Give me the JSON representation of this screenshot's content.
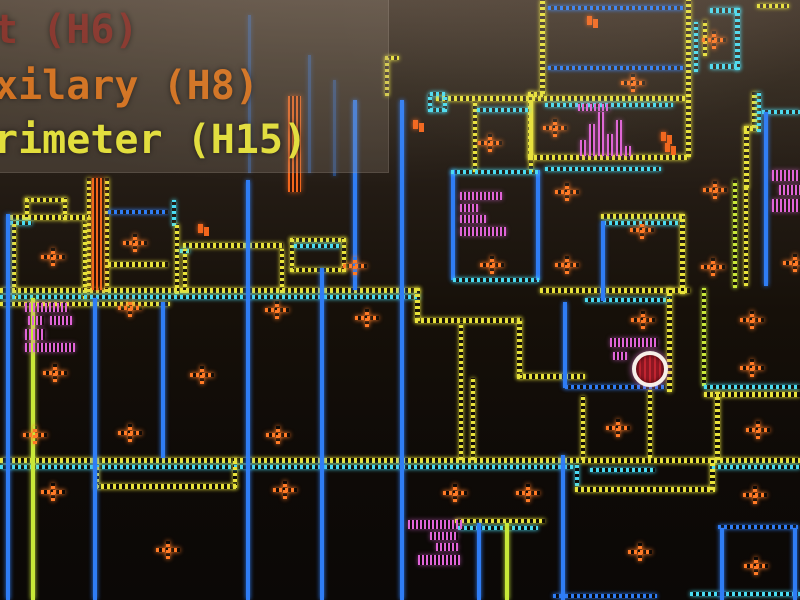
{
  "legend": {
    "items": [
      {
        "label": "t (H6)",
        "color": "#8a2e26"
      },
      {
        "label": "xilary (H8)",
        "color": "#d2711f"
      },
      {
        "label": "rimeter (H15)",
        "color": "#e2de3c"
      }
    ]
  },
  "palette": {
    "Y": "#e8e23a",
    "C": "#4adcf2",
    "B": "#2f7df5",
    "G": "#c8e838",
    "O": "#ff7a26",
    "M": "#e064d8",
    "O2": "#f2661c",
    "player_fill": "#a01828",
    "player_ring": "#f6eee8"
  },
  "map": {
    "walls": [
      [
        25,
        198,
        42,
        4,
        "Y",
        0
      ],
      [
        25,
        198,
        4,
        22,
        "Y",
        0
      ],
      [
        63,
        198,
        4,
        22,
        "Y",
        0
      ],
      [
        10,
        215,
        80,
        5,
        "Y",
        0
      ],
      [
        10,
        221,
        22,
        4,
        "C",
        0
      ],
      [
        12,
        221,
        4,
        78,
        "Y",
        0
      ],
      [
        83,
        221,
        4,
        78,
        "Y",
        0
      ],
      [
        87,
        178,
        4,
        114,
        "Y",
        0
      ],
      [
        105,
        178,
        4,
        114,
        "Y",
        0
      ],
      [
        108,
        210,
        60,
        4,
        "B",
        0
      ],
      [
        172,
        200,
        4,
        26,
        "C",
        0
      ],
      [
        175,
        224,
        4,
        70,
        "Y",
        0
      ],
      [
        108,
        262,
        60,
        5,
        "Y",
        0
      ],
      [
        183,
        243,
        100,
        5,
        "Y",
        0
      ],
      [
        180,
        249,
        10,
        4,
        "C",
        0
      ],
      [
        183,
        249,
        4,
        44,
        "Y",
        0
      ],
      [
        280,
        249,
        4,
        44,
        "Y",
        0
      ],
      [
        290,
        238,
        56,
        4,
        "Y",
        0
      ],
      [
        290,
        238,
        4,
        34,
        "Y",
        0
      ],
      [
        342,
        238,
        4,
        34,
        "Y",
        0
      ],
      [
        290,
        268,
        56,
        4,
        "Y",
        0
      ],
      [
        294,
        244,
        46,
        4,
        "C",
        0
      ],
      [
        0,
        288,
        420,
        5,
        "Y",
        0
      ],
      [
        0,
        295,
        420,
        4,
        "C",
        0
      ],
      [
        0,
        302,
        170,
        4,
        "Y",
        0
      ],
      [
        540,
        288,
        150,
        5,
        "Y",
        0
      ],
      [
        585,
        298,
        85,
        4,
        "C",
        0
      ],
      [
        415,
        288,
        5,
        33,
        "Y",
        0
      ],
      [
        415,
        318,
        106,
        5,
        "Y",
        0
      ],
      [
        517,
        318,
        5,
        60,
        "Y",
        0
      ],
      [
        517,
        374,
        68,
        5,
        "Y",
        0
      ],
      [
        459,
        322,
        4,
        138,
        "Y",
        0
      ],
      [
        471,
        378,
        4,
        82,
        "Y",
        0
      ],
      [
        563,
        302,
        4,
        86,
        "B",
        1
      ],
      [
        565,
        385,
        100,
        4,
        "B",
        0
      ],
      [
        667,
        288,
        5,
        104,
        "Y",
        0
      ],
      [
        581,
        396,
        4,
        64,
        "Y",
        0
      ],
      [
        648,
        390,
        4,
        68,
        "Y",
        0
      ],
      [
        702,
        288,
        4,
        98,
        "G",
        0
      ],
      [
        704,
        385,
        96,
        4,
        "C",
        0
      ],
      [
        704,
        392,
        96,
        5,
        "Y",
        0
      ],
      [
        715,
        392,
        5,
        68,
        "Y",
        0
      ],
      [
        601,
        214,
        82,
        5,
        "Y",
        0
      ],
      [
        603,
        221,
        78,
        4,
        "C",
        0
      ],
      [
        601,
        221,
        4,
        80,
        "B",
        1
      ],
      [
        680,
        214,
        5,
        80,
        "Y",
        0
      ],
      [
        733,
        180,
        4,
        108,
        "G",
        0
      ],
      [
        744,
        186,
        4,
        100,
        "Y",
        0
      ],
      [
        744,
        126,
        5,
        62,
        "Y",
        0
      ],
      [
        744,
        126,
        14,
        5,
        "Y",
        0
      ],
      [
        752,
        92,
        5,
        36,
        "Y",
        0
      ],
      [
        757,
        92,
        4,
        40,
        "C",
        0
      ],
      [
        762,
        110,
        38,
        4,
        "C",
        0
      ],
      [
        764,
        112,
        4,
        174,
        "B",
        1
      ],
      [
        540,
        0,
        5,
        94,
        "Y",
        0
      ],
      [
        528,
        92,
        5,
        65,
        "Y",
        0
      ],
      [
        528,
        92,
        18,
        5,
        "Y",
        0
      ],
      [
        686,
        0,
        5,
        157,
        "Y",
        0
      ],
      [
        694,
        22,
        4,
        50,
        "C",
        0
      ],
      [
        548,
        6,
        136,
        4,
        "B",
        0
      ],
      [
        548,
        66,
        136,
        4,
        "B",
        0
      ],
      [
        436,
        96,
        250,
        5,
        "Y",
        0
      ],
      [
        545,
        103,
        128,
        4,
        "C",
        0
      ],
      [
        528,
        155,
        160,
        5,
        "Y",
        0
      ],
      [
        545,
        167,
        116,
        4,
        "C",
        0
      ],
      [
        735,
        8,
        5,
        62,
        "C",
        0
      ],
      [
        710,
        8,
        30,
        5,
        "C",
        0
      ],
      [
        710,
        64,
        30,
        5,
        "C",
        0
      ],
      [
        703,
        20,
        4,
        36,
        "Y",
        0
      ],
      [
        757,
        4,
        32,
        4,
        "Y",
        0
      ],
      [
        428,
        94,
        4,
        18,
        "C",
        0
      ],
      [
        443,
        94,
        4,
        18,
        "C",
        0
      ],
      [
        430,
        92,
        15,
        4,
        "C",
        0
      ],
      [
        430,
        108,
        15,
        4,
        "C",
        0
      ],
      [
        473,
        101,
        4,
        71,
        "Y",
        0
      ],
      [
        529,
        101,
        4,
        71,
        "Y",
        0
      ],
      [
        477,
        108,
        52,
        4,
        "C",
        0
      ],
      [
        451,
        170,
        4,
        110,
        "B",
        1
      ],
      [
        536,
        170,
        4,
        110,
        "B",
        1
      ],
      [
        451,
        170,
        88,
        4,
        "C",
        0
      ],
      [
        453,
        278,
        86,
        4,
        "C",
        0
      ],
      [
        0,
        458,
        800,
        5,
        "Y",
        0
      ],
      [
        0,
        465,
        573,
        4,
        "C",
        0
      ],
      [
        712,
        465,
        88,
        4,
        "C",
        0
      ],
      [
        95,
        458,
        4,
        30,
        "Y",
        0
      ],
      [
        95,
        484,
        142,
        5,
        "Y",
        0
      ],
      [
        233,
        458,
        4,
        30,
        "Y",
        0
      ],
      [
        575,
        464,
        4,
        22,
        "C",
        0
      ],
      [
        590,
        468,
        65,
        4,
        "C",
        0
      ],
      [
        575,
        487,
        140,
        5,
        "Y",
        0
      ],
      [
        710,
        458,
        5,
        32,
        "Y",
        0
      ],
      [
        718,
        525,
        80,
        4,
        "B",
        0
      ],
      [
        455,
        519,
        90,
        4,
        "Y",
        0
      ],
      [
        458,
        526,
        80,
        4,
        "C",
        0
      ],
      [
        553,
        594,
        104,
        4,
        "B",
        0
      ],
      [
        690,
        592,
        110,
        4,
        "C",
        0
      ],
      [
        6,
        214,
        4,
        386,
        "B",
        1
      ],
      [
        31,
        298,
        4,
        302,
        "G",
        1
      ],
      [
        93,
        298,
        4,
        302,
        "B",
        1
      ],
      [
        161,
        302,
        4,
        156,
        "B",
        1
      ],
      [
        246,
        180,
        4,
        420,
        "B",
        1
      ],
      [
        320,
        268,
        4,
        332,
        "B",
        1
      ],
      [
        353,
        100,
        4,
        190,
        "B",
        1
      ],
      [
        400,
        100,
        4,
        500,
        "B",
        1
      ],
      [
        477,
        523,
        4,
        77,
        "B",
        1
      ],
      [
        505,
        523,
        4,
        77,
        "G",
        1
      ],
      [
        561,
        455,
        4,
        145,
        "B",
        1
      ],
      [
        720,
        528,
        4,
        72,
        "B",
        1
      ],
      [
        793,
        528,
        4,
        72,
        "B",
        1
      ],
      [
        248,
        15,
        3,
        158,
        "B",
        1,
        0.45
      ],
      [
        308,
        55,
        3,
        118,
        "B",
        1,
        0.45
      ],
      [
        333,
        80,
        3,
        96,
        "B",
        1,
        0.45
      ],
      [
        385,
        56,
        14,
        4,
        "Y",
        0
      ],
      [
        385,
        58,
        4,
        38,
        "Y",
        0
      ]
    ],
    "magenta_blocks": [
      [
        25,
        303,
        44,
        9
      ],
      [
        28,
        316,
        16,
        9
      ],
      [
        50,
        316,
        22,
        9
      ],
      [
        25,
        329,
        20,
        11
      ],
      [
        25,
        343,
        50,
        9
      ],
      [
        578,
        104,
        32,
        7
      ],
      [
        580,
        140,
        6,
        16
      ],
      [
        589,
        124,
        6,
        32
      ],
      [
        598,
        112,
        6,
        44
      ],
      [
        607,
        134,
        6,
        22
      ],
      [
        616,
        120,
        6,
        36
      ],
      [
        625,
        146,
        6,
        10
      ],
      [
        460,
        192,
        42,
        8
      ],
      [
        460,
        204,
        18,
        8
      ],
      [
        460,
        215,
        26,
        8
      ],
      [
        460,
        227,
        46,
        9
      ],
      [
        772,
        170,
        28,
        11
      ],
      [
        779,
        185,
        21,
        10
      ],
      [
        772,
        199,
        28,
        13
      ],
      [
        610,
        338,
        48,
        9
      ],
      [
        613,
        352,
        14,
        8
      ],
      [
        408,
        520,
        54,
        9
      ],
      [
        430,
        532,
        28,
        8
      ],
      [
        436,
        543,
        22,
        8
      ],
      [
        418,
        555,
        42,
        10
      ]
    ],
    "orange_blocks": [
      [
        92,
        178,
        12,
        112
      ],
      [
        288,
        96,
        13,
        96
      ]
    ],
    "plus_markers": [
      [
        633,
        83
      ],
      [
        714,
        40
      ],
      [
        555,
        128
      ],
      [
        490,
        143
      ],
      [
        567,
        192
      ],
      [
        715,
        190
      ],
      [
        642,
        230
      ],
      [
        567,
        265
      ],
      [
        492,
        265
      ],
      [
        713,
        267
      ],
      [
        795,
        263
      ],
      [
        53,
        257
      ],
      [
        135,
        243
      ],
      [
        277,
        310
      ],
      [
        355,
        266
      ],
      [
        367,
        318
      ],
      [
        130,
        308
      ],
      [
        55,
        373
      ],
      [
        202,
        375
      ],
      [
        643,
        320
      ],
      [
        752,
        320
      ],
      [
        752,
        368
      ],
      [
        618,
        428
      ],
      [
        758,
        430
      ],
      [
        35,
        435
      ],
      [
        130,
        433
      ],
      [
        278,
        435
      ],
      [
        53,
        492
      ],
      [
        285,
        490
      ],
      [
        455,
        493
      ],
      [
        528,
        493
      ],
      [
        755,
        495
      ],
      [
        168,
        550
      ],
      [
        640,
        552
      ],
      [
        756,
        566
      ]
    ],
    "small_markers": [
      [
        592,
        20
      ],
      [
        203,
        228
      ],
      [
        418,
        124
      ],
      [
        666,
        136
      ],
      [
        670,
        147
      ]
    ],
    "player_marker": {
      "x": 650,
      "y": 369
    }
  }
}
